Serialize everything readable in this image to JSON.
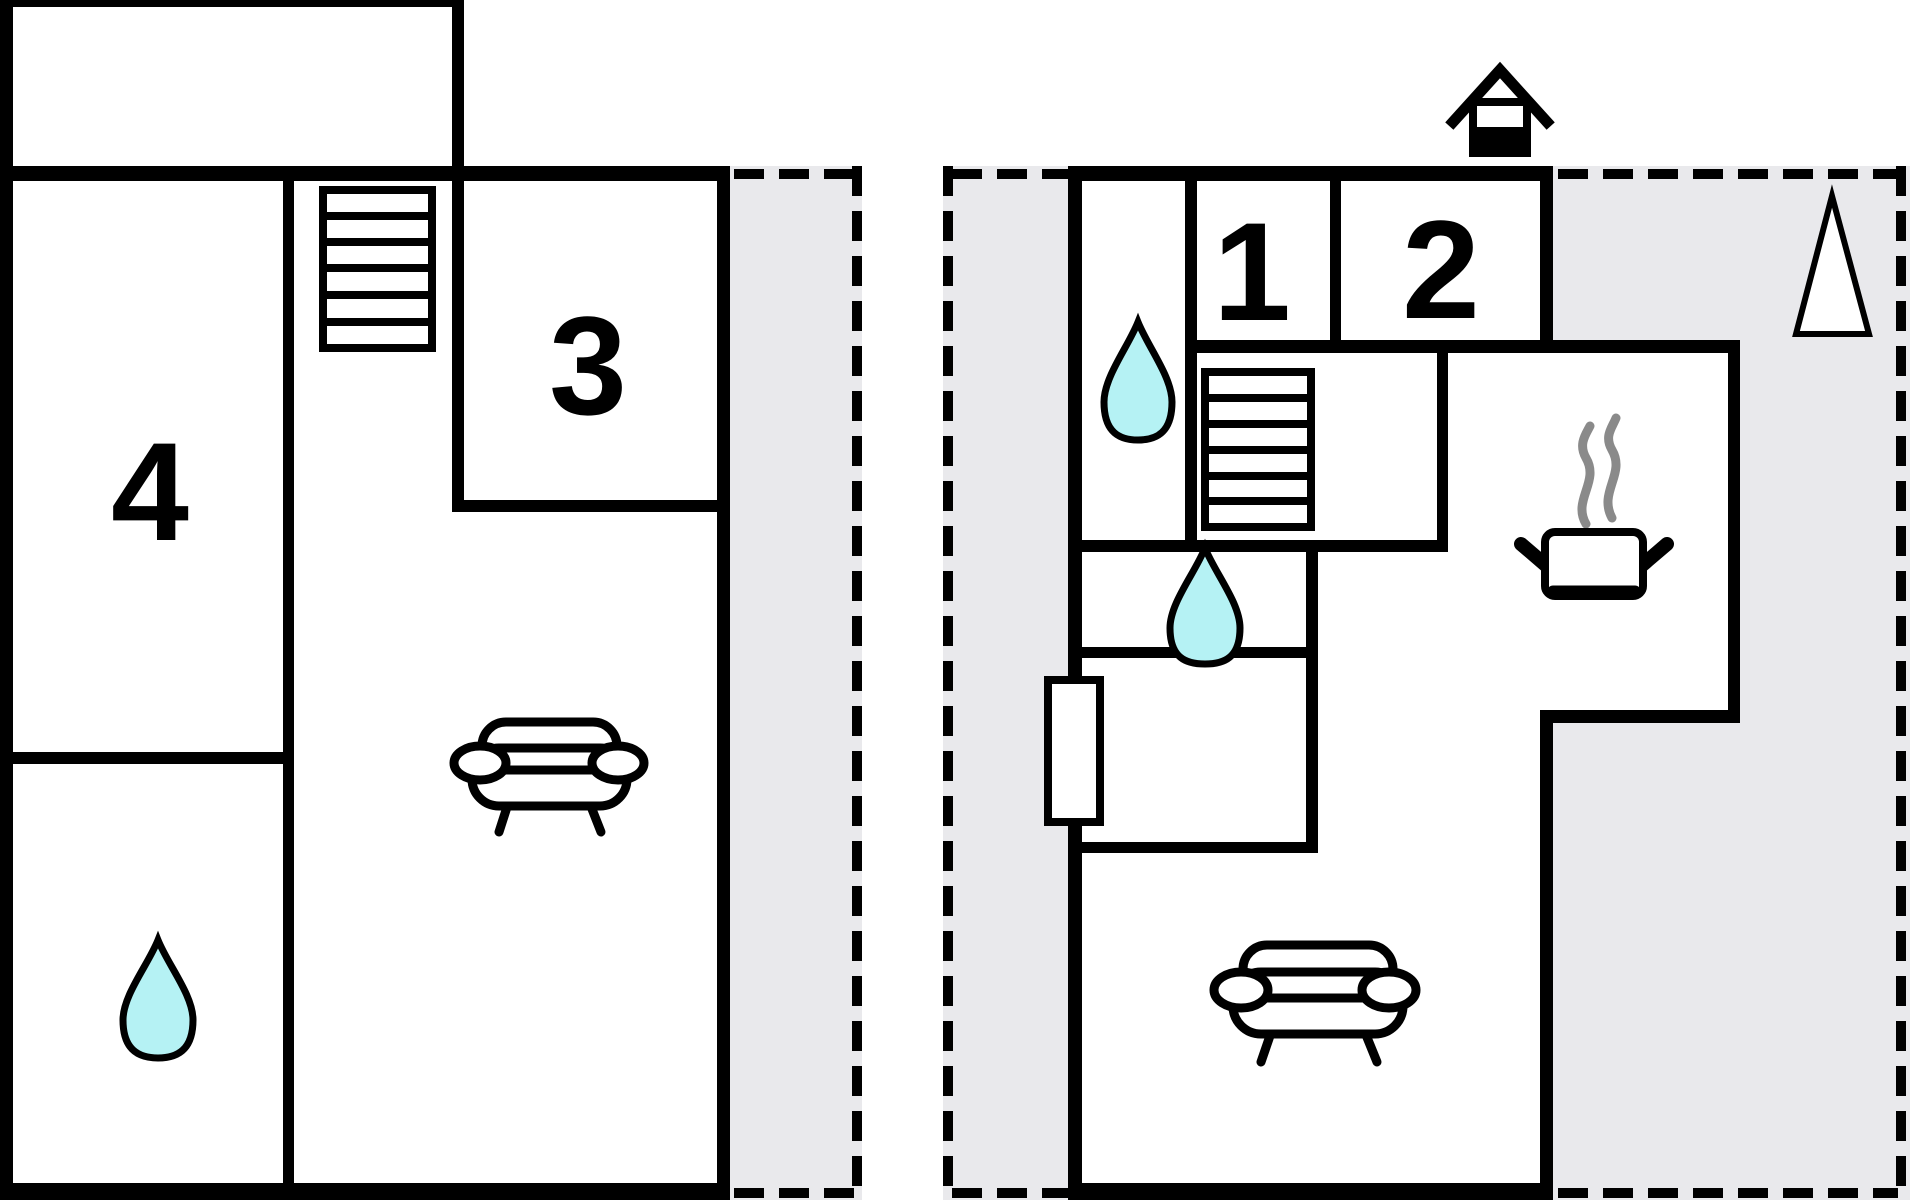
{
  "title": "two-storey holiday home floor plan",
  "rooms": {
    "r1": "1",
    "r2": "2",
    "r3": "3",
    "r4": "4"
  },
  "colors": {
    "wall": "#000000",
    "terrace": "#e9e9ec",
    "water_drop": "#b5f2f4",
    "steam": "#8a8a8a",
    "floor": "#ffffff"
  },
  "icons": {
    "staircase": "staircase-icon",
    "sofa": "sofa-icon",
    "water_drop": "water-drop-icon",
    "cooking_pot": "cooking-pot-icon",
    "chimney": "chimney-icon",
    "north_arrow": "north-arrow-icon",
    "door": "door-icon"
  }
}
